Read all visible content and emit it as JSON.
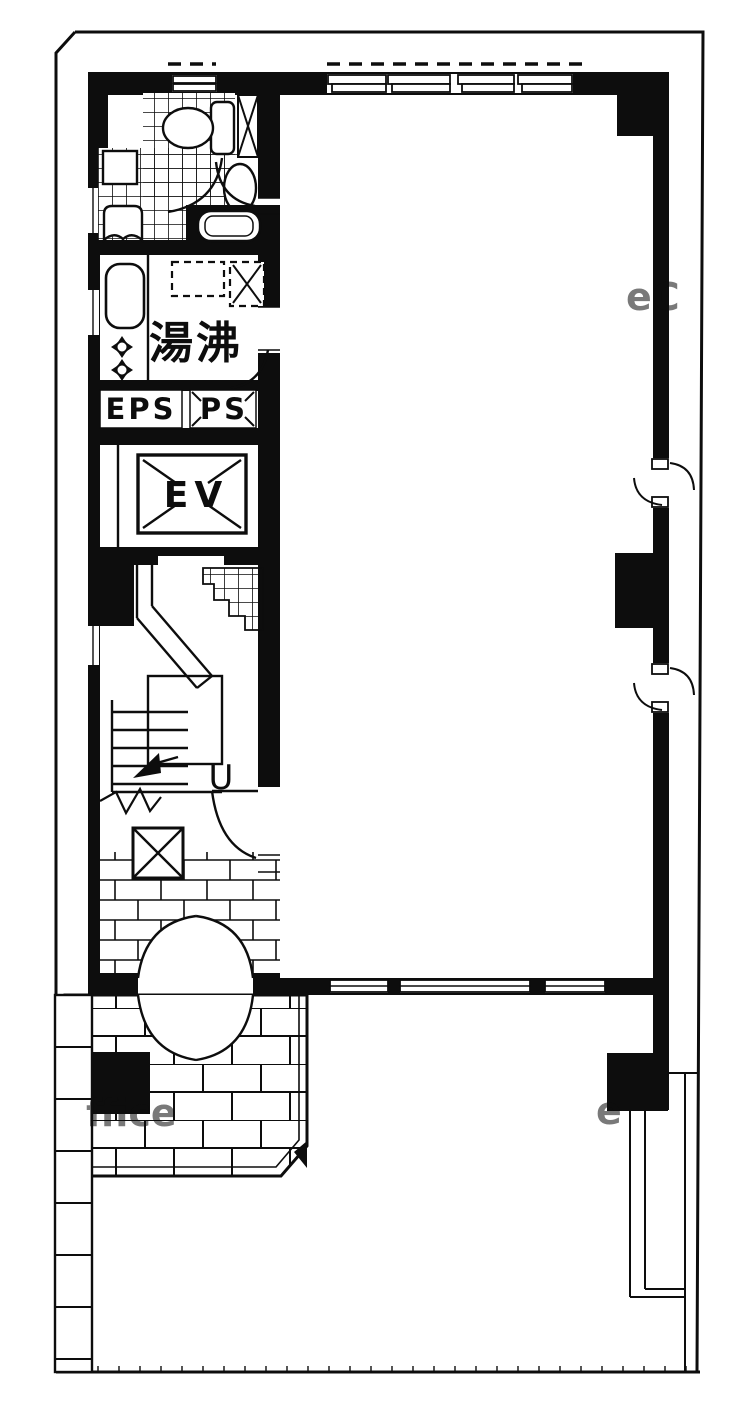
{
  "plan": {
    "labels": {
      "kitchenette": "湯沸",
      "electric_pipe_shaft": "EPS",
      "pipe_shaft": "PS",
      "elevator": "EV",
      "stair_direction": "U"
    },
    "watermark_fragments": [
      "ffice",
      "eC",
      "e"
    ],
    "colors": {
      "ink": "#0d0d0d",
      "paper": "#ffffff",
      "watermark": "#c4c4c4"
    }
  }
}
